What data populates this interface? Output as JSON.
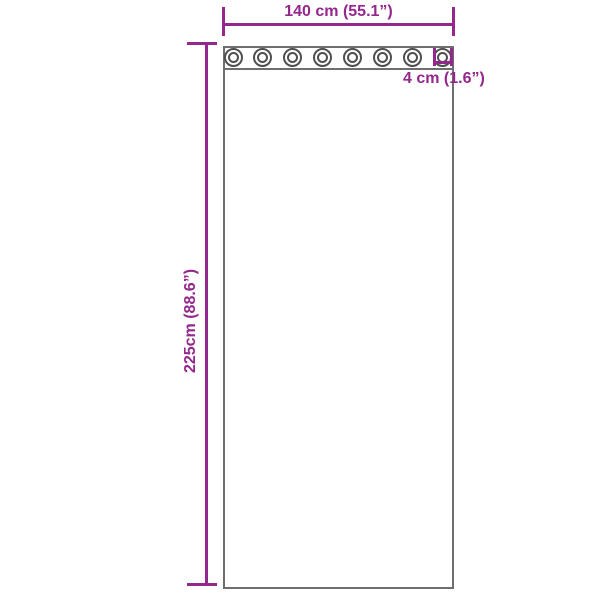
{
  "diagram": {
    "type": "product-dimension-diagram",
    "subject": "curtain panel with grommet header",
    "dimensions": {
      "width_label": "140 cm (55.1”)",
      "height_label": "225cm (88.6”)",
      "grommet_diameter_label": "4 cm (1.6”)"
    },
    "grommets": {
      "count": 8
    }
  },
  "colors": {
    "dimension": "#93278c",
    "outline": "#6e6e6e",
    "grommet_ring": "#4f4f4f",
    "background": "#ffffff"
  }
}
